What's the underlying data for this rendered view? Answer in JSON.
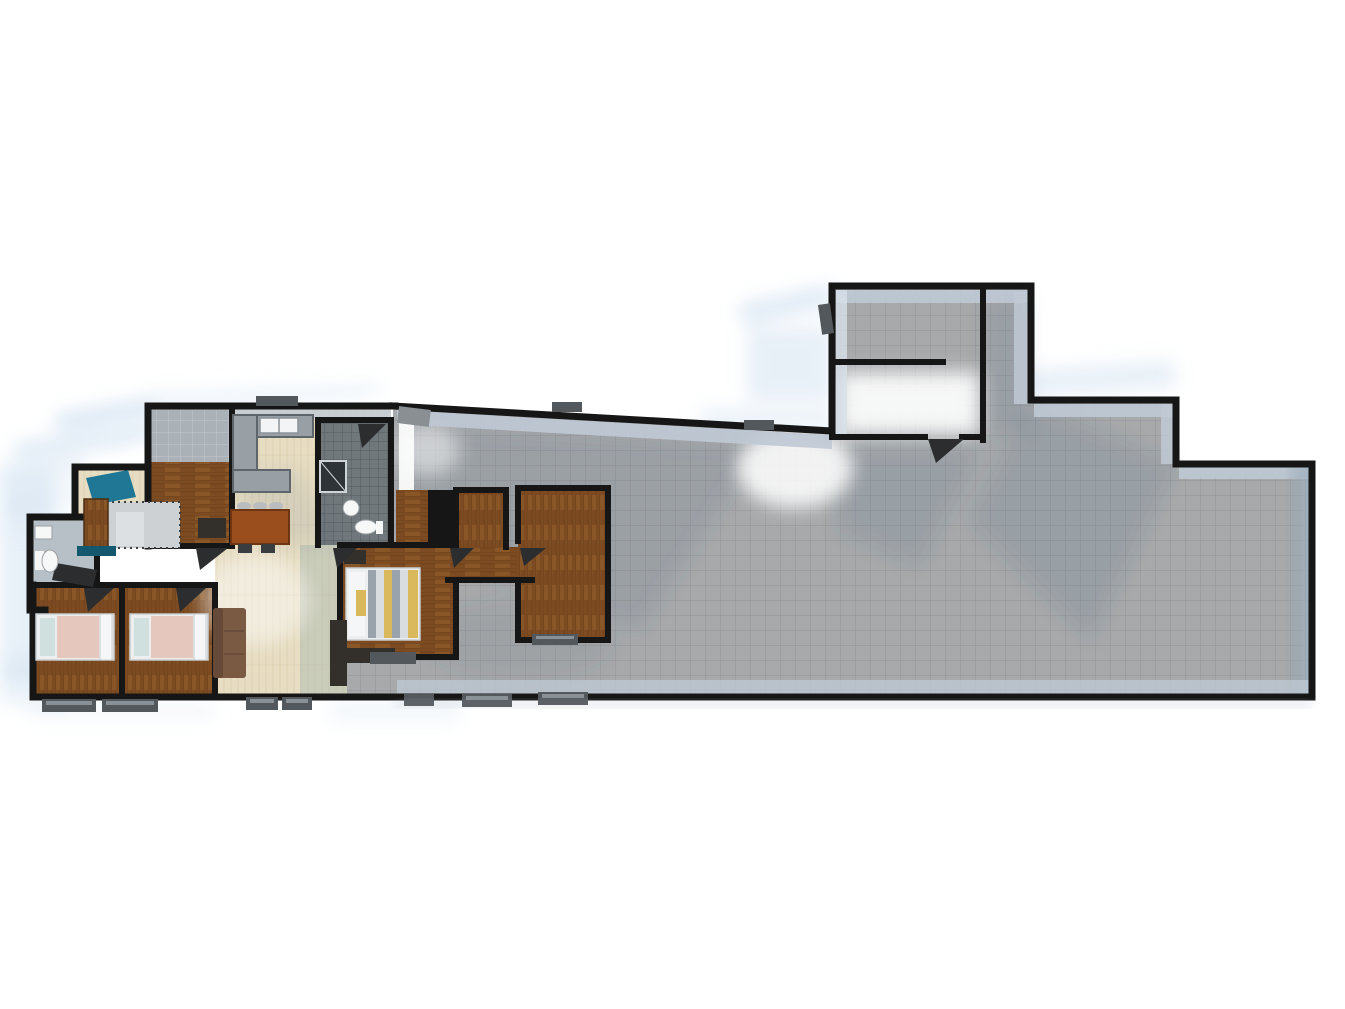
{
  "scene": {
    "type": "3d-rendered-floor-plan",
    "description": "Top-down 3D architectural render on white: furnished residential wing on the left (bedrooms, kitchen, dining, living, bathrooms, master suite), large empty gray-tiled hall extending right with a north annex room, soft blue shadow streaks cast to the left",
    "background": "#ffffff"
  },
  "colors": {
    "background": "#ffffff",
    "wall": "#161616",
    "hall_floor": "#a7a9ab",
    "wall_face": "#bfc9d4",
    "wall_face_light": "#d8e0e8",
    "face_tile": "#aab2b7",
    "shadow_blue": "#cfe0f0",
    "sun_white": "#ffffff",
    "floor_shadow": "#3d5a78",
    "wood": "#7c4b21",
    "wood_line": "#5a3514",
    "living_floor": "#e7ddc3",
    "living_line": "#cabb97",
    "green_shadow": "#9fb4ac",
    "bath_dark": "#71787c",
    "bath_light": "#b7c0c6",
    "counter": "#99a0a5",
    "counter_edge": "#5f666b",
    "sink_white": "#f2f4f5",
    "table": "#9a4e1e",
    "stool": "#b9bdbf",
    "seat_dark": "#3a3d3f",
    "sofa": "#7b5a43",
    "sofa_back": "#664a37",
    "bed_frame": "#eceeef",
    "bed_pink": "#e6c7bd",
    "pillow": "#f5f6f7",
    "headboard": "#cfe0df",
    "bed_stripe_a": "#98a3ac",
    "bed_stripe_b": "#dadde0",
    "bed_stripe_c": "#d9b95c",
    "furniture_dark": "#33302c",
    "door_leaf": "#2b2d2f",
    "door_gray": "#8a8f93",
    "teal": "#1f7795",
    "teal_dark": "#14586f",
    "rug": "#cdd1d4",
    "sill": "#53585c",
    "sill_light": "#8a9196",
    "shower": "#2e3337",
    "toilet_white": "#f6f8f8"
  },
  "rooms": [
    {
      "name": "great-hall",
      "floor": "gray-tile"
    },
    {
      "name": "annex-room-north",
      "floor": "gray-tile"
    },
    {
      "name": "bedroom-top-left",
      "floor": "dark-wood"
    },
    {
      "name": "kitchen",
      "floor": "light-wood"
    },
    {
      "name": "dining-area",
      "floor": "light-wood"
    },
    {
      "name": "entry-vestibule",
      "floor": "light-wood-rug"
    },
    {
      "name": "bathroom-left",
      "floor": "light-tile"
    },
    {
      "name": "bedroom-1",
      "floor": "dark-wood"
    },
    {
      "name": "bedroom-2",
      "floor": "dark-wood"
    },
    {
      "name": "living-area",
      "floor": "light-wood"
    },
    {
      "name": "master-bathroom",
      "floor": "dark-tile"
    },
    {
      "name": "master-bedroom",
      "floor": "dark-wood"
    },
    {
      "name": "wood-corridor-suite",
      "floor": "dark-wood"
    }
  ],
  "furniture": [
    "kitchen-counter",
    "double-sink",
    "dining-table",
    "bar-stools",
    "dining-chairs",
    "sofa",
    "single-bed-1",
    "single-bed-2",
    "double-bed",
    "nightstand",
    "dresser",
    "wardrobe",
    "toilet",
    "wash-basin",
    "shower",
    "entry-cabinet",
    "entry-rug",
    "teal-canopy",
    "desk"
  ]
}
